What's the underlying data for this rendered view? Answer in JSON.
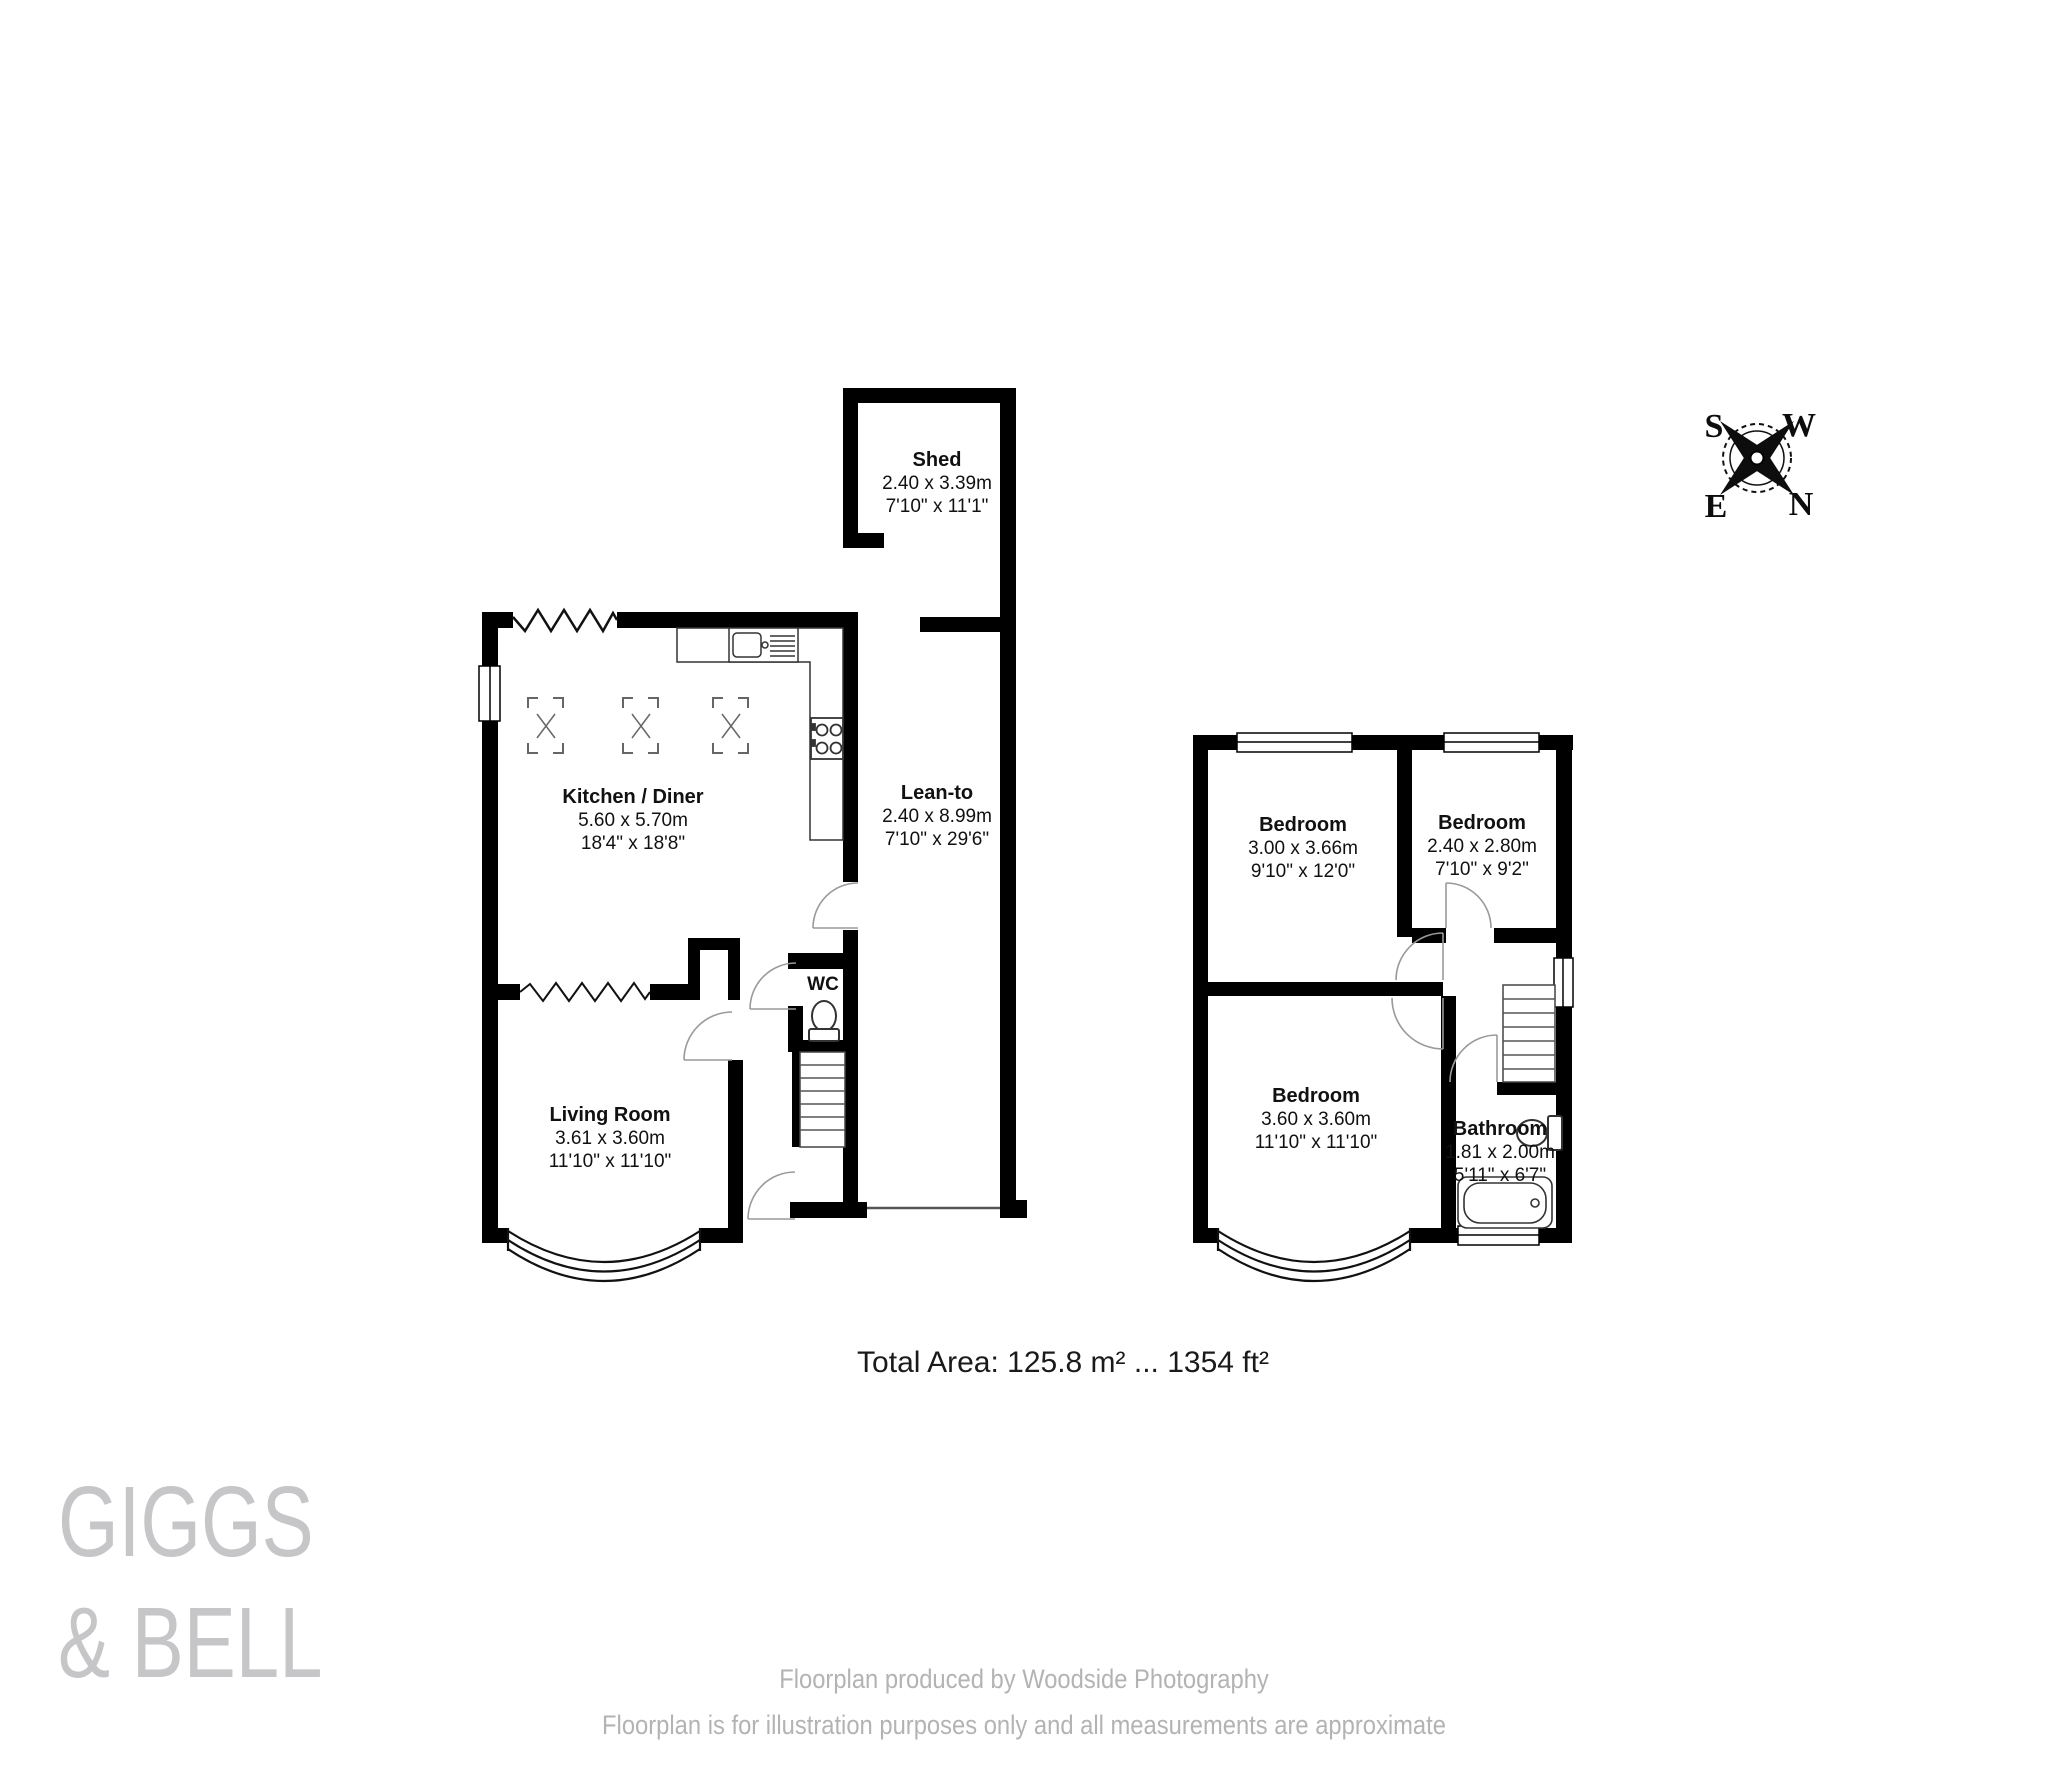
{
  "header": {
    "total_area": "Total Area: 125.8 m² ... 1354 ft²"
  },
  "compass": {
    "north": "N",
    "south": "S",
    "east": "E",
    "west": "W"
  },
  "ground_floor": {
    "shed": {
      "name": "Shed",
      "metric": "2.40 x 3.39m",
      "imperial": "7'10\" x 11'1\""
    },
    "kitchen": {
      "name": "Kitchen / Diner",
      "metric": "5.60 x 5.70m",
      "imperial": "18'4\" x 18'8\""
    },
    "lean_to": {
      "name": "Lean-to",
      "metric": "2.40 x 8.99m",
      "imperial": "7'10\" x 29'6\""
    },
    "wc": {
      "name": "WC"
    },
    "living_room": {
      "name": "Living Room",
      "metric": "3.61 x 3.60m",
      "imperial": "11'10\" x 11'10\""
    }
  },
  "first_floor": {
    "bedroom1": {
      "name": "Bedroom",
      "metric": "3.00 x 3.66m",
      "imperial": "9'10\" x 12'0\""
    },
    "bedroom2": {
      "name": "Bedroom",
      "metric": "2.40 x 2.80m",
      "imperial": "7'10\" x 9'2\""
    },
    "bedroom3": {
      "name": "Bedroom",
      "metric": "3.60 x 3.60m",
      "imperial": "11'10\" x 11'10\""
    },
    "bathroom": {
      "name": "Bathroom",
      "metric": "1.81 x 2.00m",
      "imperial": "5'11\" x 6'7\""
    }
  },
  "branding": {
    "line1": "GIGGS",
    "line2": "& BELL"
  },
  "footer": {
    "line1": "Floorplan produced by Woodside Photography",
    "line2": "Floorplan is for illustration purposes only and all measurements are approximate"
  },
  "colors": {
    "wall": "#000000",
    "label_text": "#111111",
    "logo_gray": "#c6c6c8",
    "footer_gray": "#b3b3b3"
  }
}
